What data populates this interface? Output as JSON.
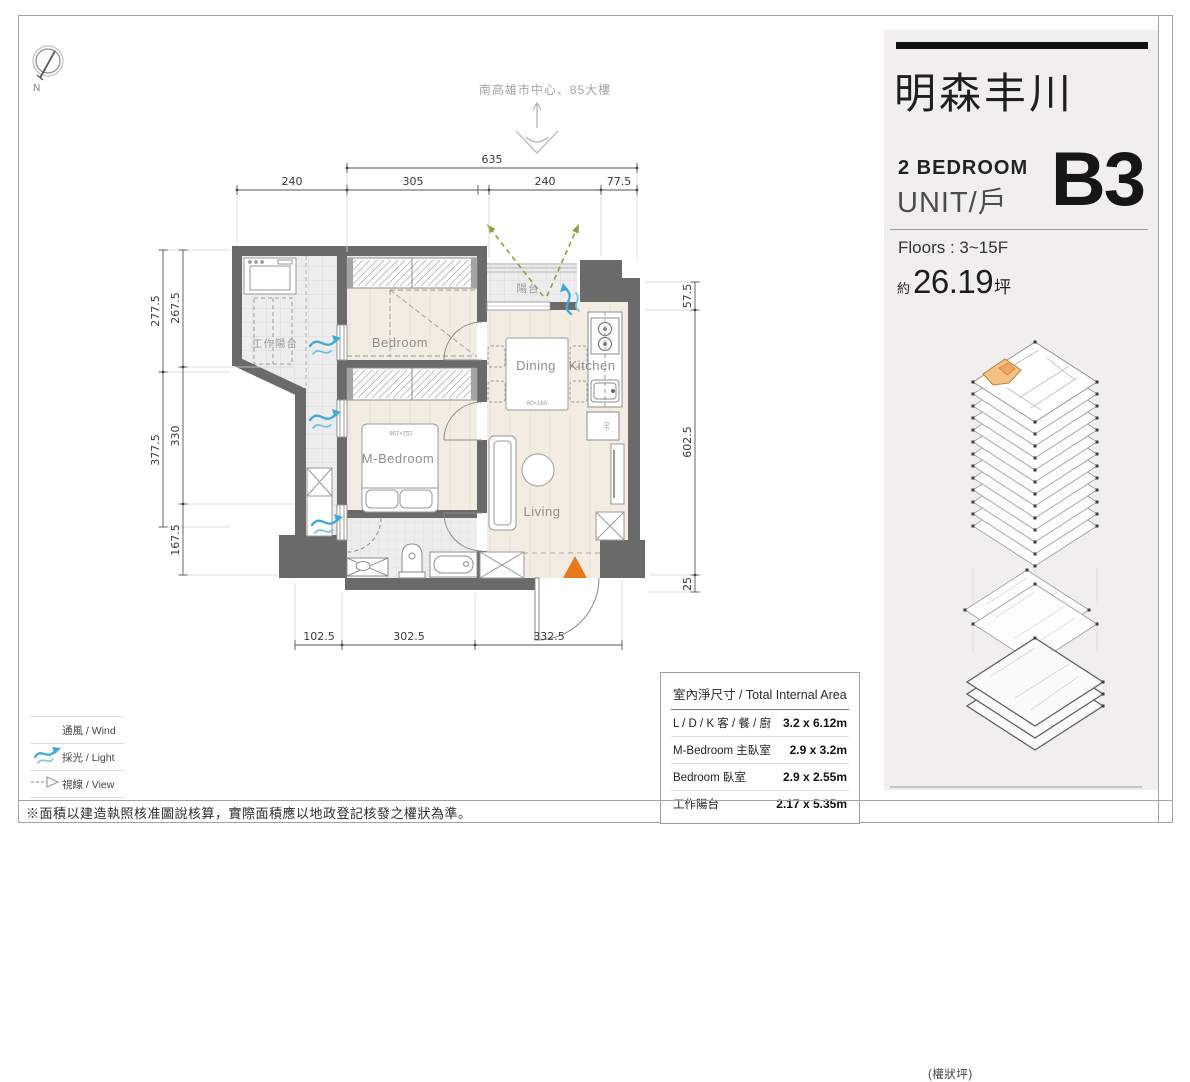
{
  "page": {
    "note": "※面積以建造執照核准圖說核算，實際面積應以地政登記核發之權狀為準。"
  },
  "compass": {
    "north": "N"
  },
  "annotations": {
    "direction": "南高雄市中心、85大樓"
  },
  "plan": {
    "labels": {
      "work_balcony": "工作陽台",
      "bedroom": "Bedroom",
      "balcony": "陽台",
      "dining": "Dining",
      "kitchen": "Kitchen",
      "m_bedroom": "M-Bedroom",
      "living": "Living",
      "bed_size": "152×196",
      "table_size": "80×160",
      "fridge": "RF"
    },
    "dims": {
      "top_total": "635",
      "top1": "240",
      "top2": "305",
      "top3": "240",
      "top4": "77.5",
      "left_out1": "277.5",
      "left_out2": "377.5",
      "left_in1": "267.5",
      "left_in2": "330",
      "left_in3": "167.5",
      "right1": "57.5",
      "right2": "602.5",
      "right3": "25",
      "bottom1": "102.5",
      "bottom2": "302.5",
      "bottom3": "332.5"
    }
  },
  "panel": {
    "project_title": "明森丰川",
    "bedroom_line": "2  BEDROOM",
    "unit_line": "UNIT/戶",
    "unit_code": "B3",
    "floors": "Floors : 3~15F",
    "area_prefix": "約",
    "area_value": "26.19",
    "area_unit": "坪",
    "area_note": "(權狀坪)"
  },
  "area_table": {
    "title": "室內淨尺寸 / Total Internal Area",
    "rows": [
      {
        "name": "L / D / K  客 / 餐 / 廚",
        "size": "3.2 x 6.12m"
      },
      {
        "name": "M-Bedroom  主臥室",
        "size": "2.9 x 3.2m"
      },
      {
        "name": "Bedroom  臥室",
        "size": "2.9 x 2.55m"
      },
      {
        "name": "工作陽台",
        "size": "2.17 x 5.35m"
      }
    ]
  },
  "legend": {
    "items": [
      {
        "label": "通風 / Wind"
      },
      {
        "label": "採光 / Light"
      },
      {
        "label": "視線 / View"
      }
    ]
  },
  "colors": {
    "wall": "#6a6a6a",
    "wind_blue": "#3fa9dc",
    "view_green": "#85a33c",
    "entrance_orange": "#e87a1e",
    "unit_highlight": "#f5c183"
  }
}
